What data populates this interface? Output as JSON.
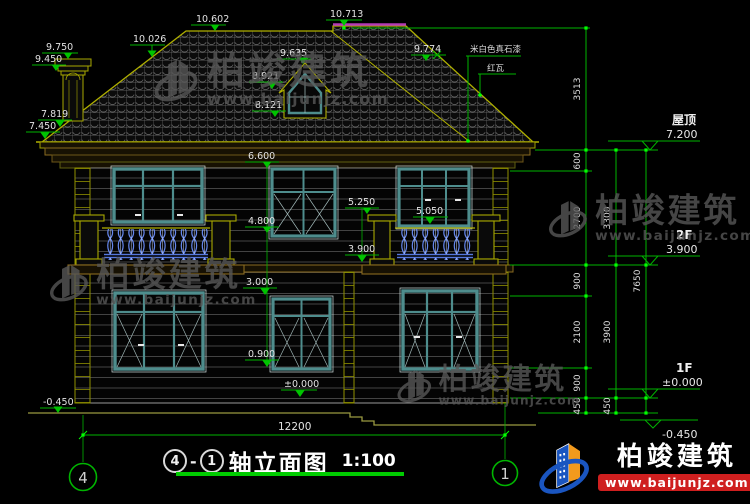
{
  "title_block": {
    "axis_left": "4",
    "dash": "-",
    "axis_right": "1",
    "name": "轴立面图",
    "scale": "1:100"
  },
  "axis_bubbles": {
    "left": "4",
    "right": "1"
  },
  "watermark": {
    "name": "柏竣建筑",
    "site": "www.baijunjz.com"
  },
  "brand": {
    "name": "柏竣建筑",
    "site": "www.baijunjz.com"
  },
  "notes": {
    "stone": "米白色真石漆",
    "tile": "红瓦"
  },
  "levels": {
    "roof_label": "屋顶",
    "roof_value": "7.200",
    "f2_label": "2F",
    "f2_value": "3.900",
    "f1_label": "1F",
    "f1_value": "±0.000",
    "base_value": "-0.450"
  },
  "dims": {
    "d10602": "10.602",
    "d10713": "10.713",
    "d10026": "10.026",
    "d9750": "9.750",
    "d9450": "9.450",
    "d9635": "9.635",
    "d8921": "8.921",
    "d8121": "8.121",
    "d9774": "9.774",
    "d7819": "7.819",
    "d7450": "7.450",
    "d6600": "6.600",
    "d5250": "5.250",
    "d5050": "5.050",
    "d4800": "4.800",
    "d3900": "3.900",
    "d3000": "3.000",
    "d0900": "0.900",
    "d0000": "±0.000",
    "dneg450": "-0.450",
    "total": "12200"
  },
  "right_dims": {
    "c1": [
      "600",
      "2700",
      "900",
      "2100",
      "900",
      "450"
    ],
    "c2": [
      "3300",
      "3900",
      "450"
    ],
    "c3": [
      "3513",
      "7650"
    ]
  },
  "colors": {
    "dim_green": "#00b400",
    "node_green": "#00ff00",
    "outline_yellow": "#a8a800",
    "ridge_purple": "#b53ab5",
    "window_teal": "#4e8d8d",
    "baluster_blue": "#5577dd",
    "underline_green": "#00cc00",
    "logo_blue": "#1a55c0",
    "logo_orange": "#f29a1d",
    "logo_red": "#cf1f1f"
  }
}
